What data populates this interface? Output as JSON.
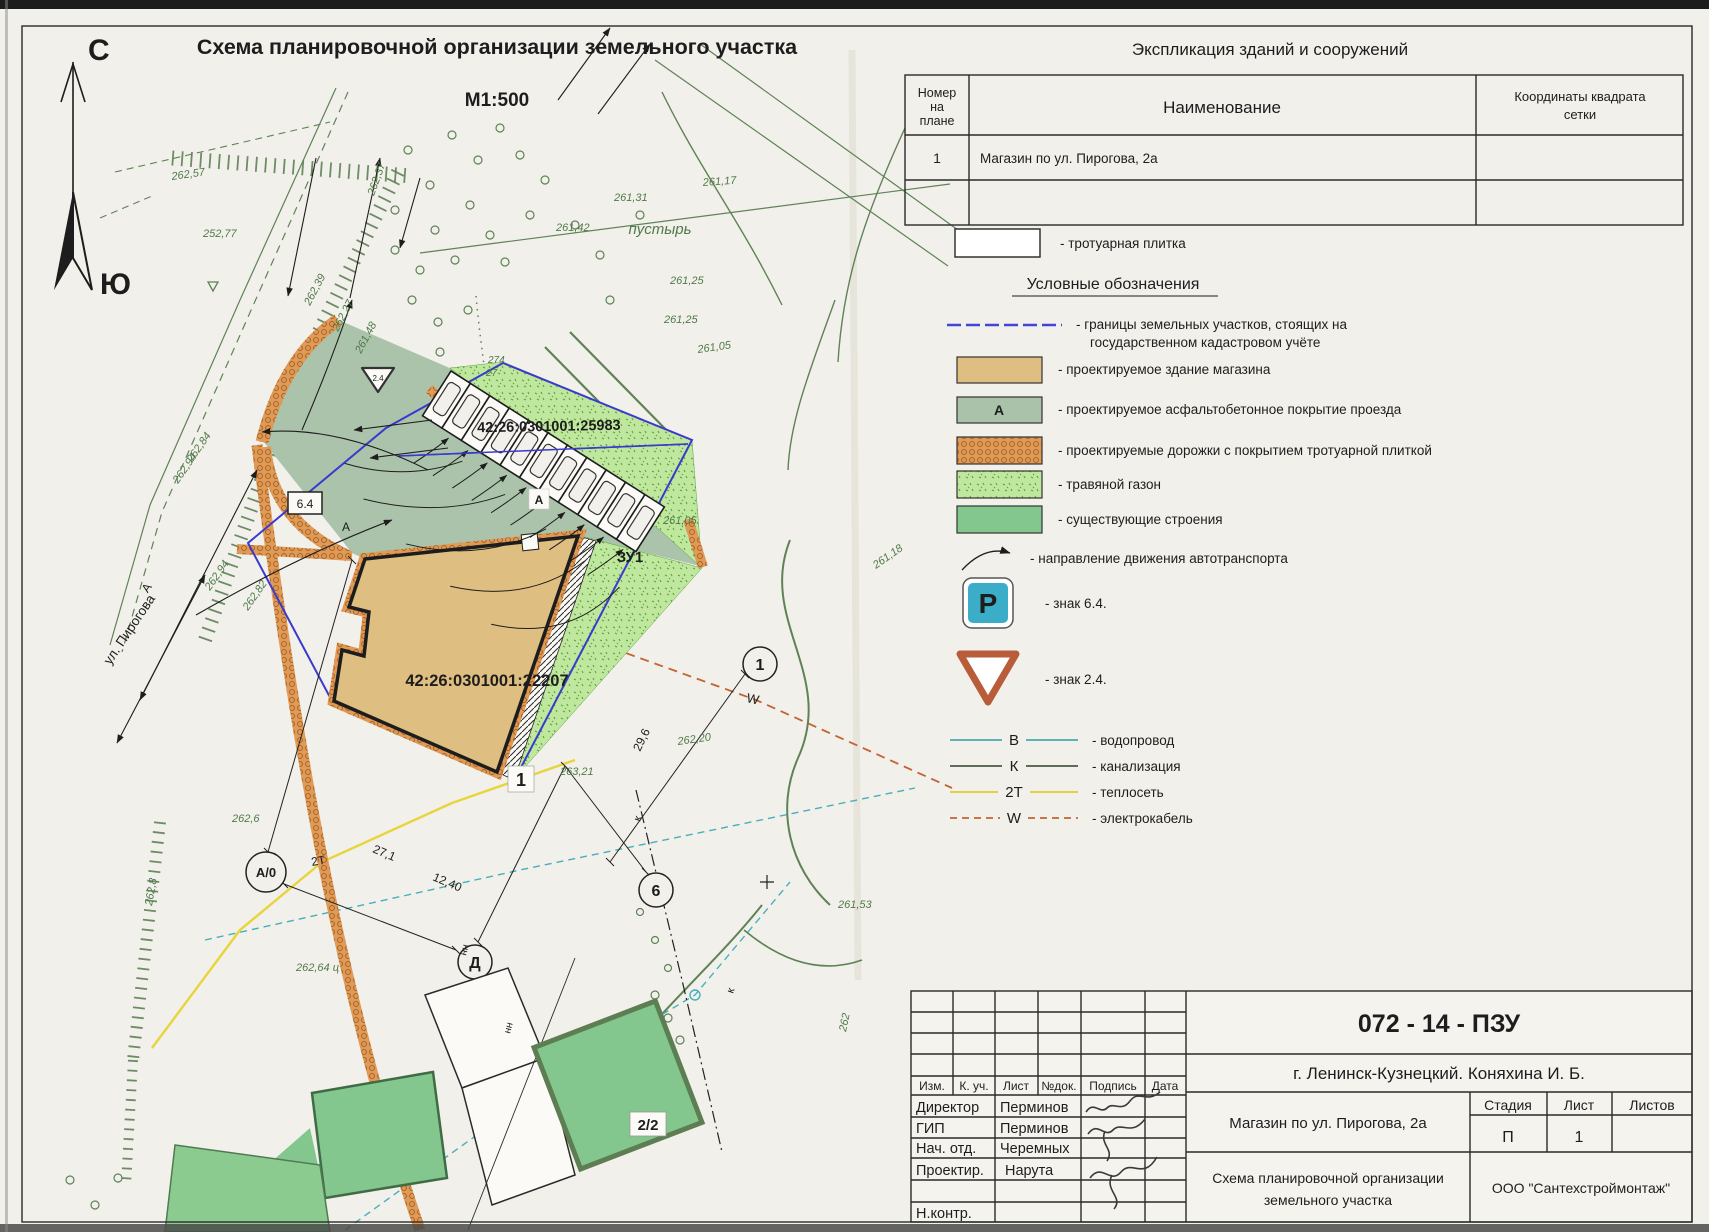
{
  "header": {
    "title": "Схема планировочной организации земельного участка",
    "scale": "М1:500",
    "north": "С",
    "south": "Ю"
  },
  "explication": {
    "title": "Экспликация зданий и сооружений",
    "col1a": "Номер",
    "col1b": "на",
    "col1c": "плане",
    "col2": "Наименование",
    "col3a": "Координаты квадрата",
    "col3b": "сетки",
    "row_num": "1",
    "row_name": "Магазин по ул. Пирогова, 2а"
  },
  "legend": {
    "paving": "-  тротуарная плитка",
    "title": "Условные обозначения",
    "boundary1": "-  границы земельных участков, стоящих на",
    "boundary2": "государственном кадастровом учёте",
    "building": "-  проектируемое здание магазина",
    "asphalt": "-  проектируемое асфальтобетонное покрытие проезда",
    "asphalt_letter": "А",
    "paths": "-  проектируемые дорожки с покрытием тротуарной плиткой",
    "lawn": "-  травяной газон",
    "existing": "-  существующие строения",
    "direction": "-  направление движения автотранспорта",
    "sign64": "-  знак 6.4.",
    "sign64_letter": "Р",
    "sign24": "-  знак 2.4.",
    "water_letter": "В",
    "water": "-  водопровод",
    "sewer_letter": "К",
    "sewer": "-  канализация",
    "heat_letter": "2Т",
    "heat": "-  теплосеть",
    "cable_letter": "W",
    "cable": "-  электрокабель",
    "colors": {
      "accent_blue": "#4444d8",
      "parking_sign": "#3badc9",
      "yield_sign": "#b85c3a"
    }
  },
  "map": {
    "cad_building": "42:26:0301001:22207",
    "cad_parking": "42:26:0301001:25983",
    "plot": "ЗУ1",
    "building_no": "1",
    "existing_no": "2/2",
    "street": "ул. Пирогова",
    "street_letter": "А",
    "wasteland": "пустырь",
    "sign64": "6.4",
    "sign24": "2.4",
    "asphalt_letter1": "А",
    "asphalt_letter2": "А",
    "marker_a0": "А/0",
    "marker_d": "Д",
    "marker_6": "6",
    "marker_1": "1",
    "dim1": "27,1",
    "dim2": "12,40",
    "dim3": "29,6",
    "heat_label": "2Т",
    "cable_label": "W",
    "sewer_label1": "к",
    "sewer_label2": "к",
    "nn1": "нн",
    "nn2": "нн",
    "elevations": [
      "262,57",
      "252,77",
      "262,39",
      "262,27",
      "261,48",
      "262,37",
      "261,31",
      "261,17",
      "261,42",
      "261,25",
      "261,25",
      "261,05",
      "261,05",
      "261,18",
      "262,20",
      "263,21",
      "262,64 ц",
      "262,6",
      "262,94",
      "262,82",
      "262,84",
      "262,94",
      "261,53",
      "262,8",
      "274",
      "27",
      "262"
    ]
  },
  "titleblock": {
    "doc_no": "072 - 14 - ПЗУ",
    "city": "г. Ленинск-Кузнецкий. Коняхина И. Б.",
    "col_izm": "Изм.",
    "col_kuch": "К. уч.",
    "col_list": "Лист",
    "col_ndok": "№док.",
    "col_podpis": "Подпись",
    "col_data": "Дата",
    "r1_role": "Директор",
    "r1_name": "Перминов",
    "r2_role": "ГИП",
    "r2_name": "Перминов",
    "r3_role": "Нач. отд.",
    "r3_name": "Черемных",
    "r4_role": "Проектир.",
    "r4_name": "Нарута",
    "r5_role": "Н.контр.",
    "object": "Магазин по ул. Пирогова, 2а",
    "sheet1": "Схема планировочной организации",
    "sheet2": "земельного участка",
    "stage_h1": "Стадия",
    "stage_h2": "Лист",
    "stage_h3": "Листов",
    "stage_v1": "П",
    "stage_v2": "1",
    "company": "ООО \"Сантехстроймонтаж\""
  }
}
